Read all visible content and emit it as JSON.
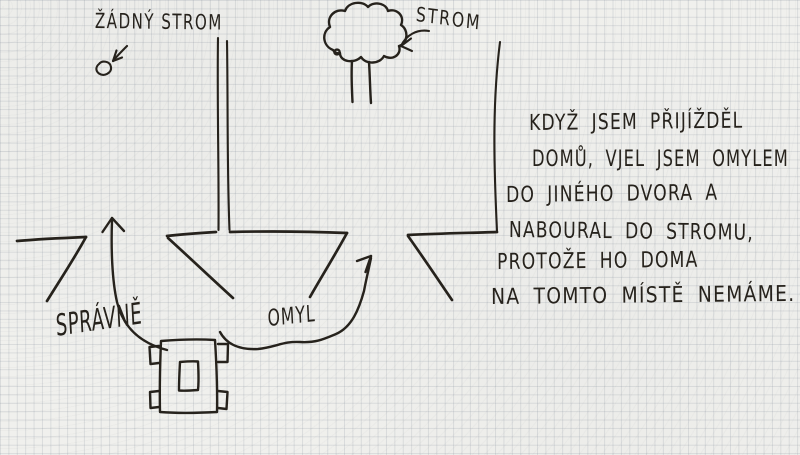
{
  "sketch": {
    "labels": {
      "no_tree": "ŽÁDNÝ STROM",
      "tree": "STROM",
      "correct_way": "SPRÁVNĚ",
      "mistake_way": "OMYL"
    },
    "note_lines": [
      "KDYŽ JSEM PŘIJÍŽDĚL",
      "DOMŮ, VJEL JSEM OMYLEM",
      "DO JINÉHO DVORA A",
      "NABOURAL DO STROMU,",
      "PROTOŽE HO DOMA",
      "NA TOMTO MÍSTĚ NEMÁME."
    ],
    "colors": {
      "ink": "#26221c",
      "paper": "#f0f0ed",
      "grid_line": "#d9dce1"
    }
  }
}
